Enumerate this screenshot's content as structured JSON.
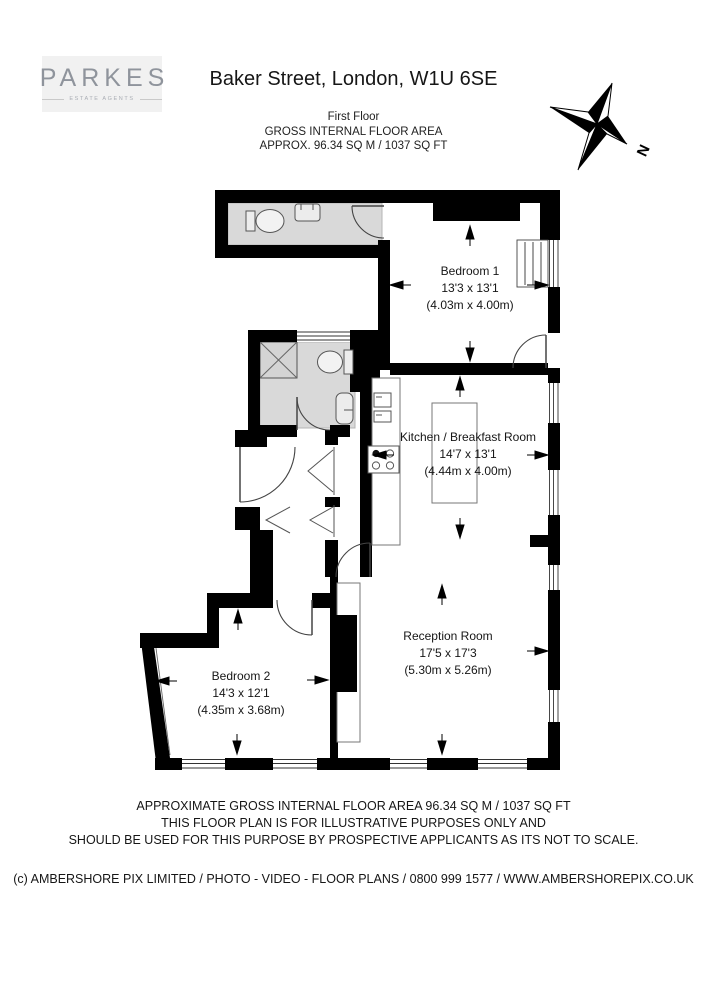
{
  "header": {
    "logo": {
      "name": "PARKES",
      "tagline": "ESTATE AGENTS"
    },
    "title": "Baker Street, London, W1U 6SE",
    "floor_label": "First Floor",
    "area_line1": "GROSS INTERNAL FLOOR AREA",
    "area_line2": "APPROX. 96.34 SQ M / 1037 SQ FT"
  },
  "compass": {
    "label": "N"
  },
  "rooms": [
    {
      "name": "Bedroom 1",
      "imperial": "13'3 x 13'1",
      "metric": "(4.03m x 4.00m)"
    },
    {
      "name": "Kitchen / Breakfast Room",
      "imperial": "14'7 x 13'1",
      "metric": "(4.44m x 4.00m)"
    },
    {
      "name": "Reception Room",
      "imperial": "17'5 x 17'3",
      "metric": "(5.30m x 5.26m)"
    },
    {
      "name": "Bedroom 2",
      "imperial": "14'3 x 12'1",
      "metric": "(4.35m x 3.68m)"
    }
  ],
  "footer": {
    "disclaimer_line1": "APPROXIMATE GROSS INTERNAL FLOOR AREA 96.34 SQ M / 1037 SQ FT",
    "disclaimer_line2": "THIS FLOOR PLAN IS FOR ILLUSTRATIVE PURPOSES ONLY AND",
    "disclaimer_line3": "SHOULD BE USED FOR THIS PURPOSE BY PROSPECTIVE APPLICANTS AS ITS NOT TO SCALE.",
    "copyright": "(c) AMBERSHORE PIX LIMITED / PHOTO - VIDEO - FLOOR PLANS / 0800 999 1577 / WWW.AMBERSHOREPIX.CO.UK"
  },
  "colors": {
    "wall": "#000000",
    "bathroom_floor": "#d9d9d9",
    "logo_gray": "#8f949c"
  }
}
